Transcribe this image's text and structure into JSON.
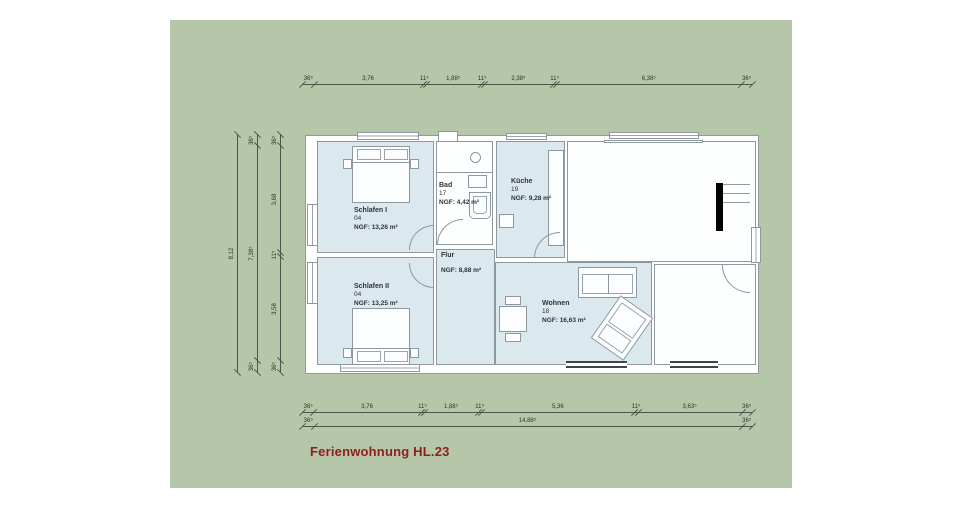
{
  "title": {
    "text": "Ferienwohnung HL.23"
  },
  "colors": {
    "sheet_green": "#b6c6a9",
    "room_fill_blue": "#dbe8ee",
    "drawing_line_gray": "#8d98a0",
    "title_red": "#8e1f1f",
    "chimney_black": "#000000"
  },
  "rooms": [
    {
      "name": "Schlafen I",
      "number": "04",
      "area": "NGF: 13,26 m²"
    },
    {
      "name": "Schlafen II",
      "number": "04",
      "area": "NGF: 13,25 m²"
    },
    {
      "name": "Bad",
      "number": "17",
      "area": "NGF: 4,42 m²"
    },
    {
      "name": "Küche",
      "number": "19",
      "area": "NGF: 9,28 m²"
    },
    {
      "name": "Flur",
      "number": "",
      "area": "NGF: 8,88 m²"
    },
    {
      "name": "Wohnen",
      "number": "18",
      "area": "NGF: 16,63 m²"
    }
  ],
  "dimensions": {
    "top": {
      "segments": [
        {
          "label": "36⁵",
          "span": 0.365
        },
        {
          "label": "3,76",
          "span": 3.76
        },
        {
          "label": "11⁵",
          "span": 0.115
        },
        {
          "label": "1,88⁵",
          "span": 1.885
        },
        {
          "label": "11⁵",
          "span": 0.115
        },
        {
          "label": "2,38⁵",
          "span": 2.385
        },
        {
          "label": "11⁵",
          "span": 0.115
        },
        {
          "label": "6,38⁵",
          "span": 6.385
        },
        {
          "label": "36⁵",
          "span": 0.365
        }
      ]
    },
    "bottom": {
      "segments": [
        {
          "label": "36⁵",
          "span": 0.365
        },
        {
          "label": "3,76",
          "span": 3.76
        },
        {
          "label": "11⁵",
          "span": 0.115
        },
        {
          "label": "1,88⁵",
          "span": 1.885
        },
        {
          "label": "11⁵",
          "span": 0.115
        },
        {
          "label": "5,36",
          "span": 5.36
        },
        {
          "label": "11⁵",
          "span": 0.115
        },
        {
          "label": "3,63⁵",
          "span": 3.635
        },
        {
          "label": "36⁵",
          "span": 0.365
        }
      ]
    },
    "bottom_total": {
      "segments": [
        {
          "label": "36⁵",
          "span": 0.365
        },
        {
          "label": "14,88⁵",
          "span": 14.885
        },
        {
          "label": "36⁵",
          "span": 0.365
        }
      ]
    },
    "left_inner": {
      "segments": [
        {
          "label": "36⁵",
          "span": 0.365
        },
        {
          "label": "3,58",
          "span": 3.58
        },
        {
          "label": "11⁵",
          "span": 0.115
        },
        {
          "label": "3,68",
          "span": 3.68
        },
        {
          "label": "36⁵",
          "span": 0.365
        }
      ]
    },
    "left_middle": {
      "segments": [
        {
          "label": "36⁵",
          "span": 0.365
        },
        {
          "label": "7,38⁵",
          "span": 7.385
        },
        {
          "label": "36⁵",
          "span": 0.365
        }
      ]
    },
    "left_outer": {
      "segments": [
        {
          "label": "8,12",
          "span": 8.12
        }
      ]
    }
  }
}
